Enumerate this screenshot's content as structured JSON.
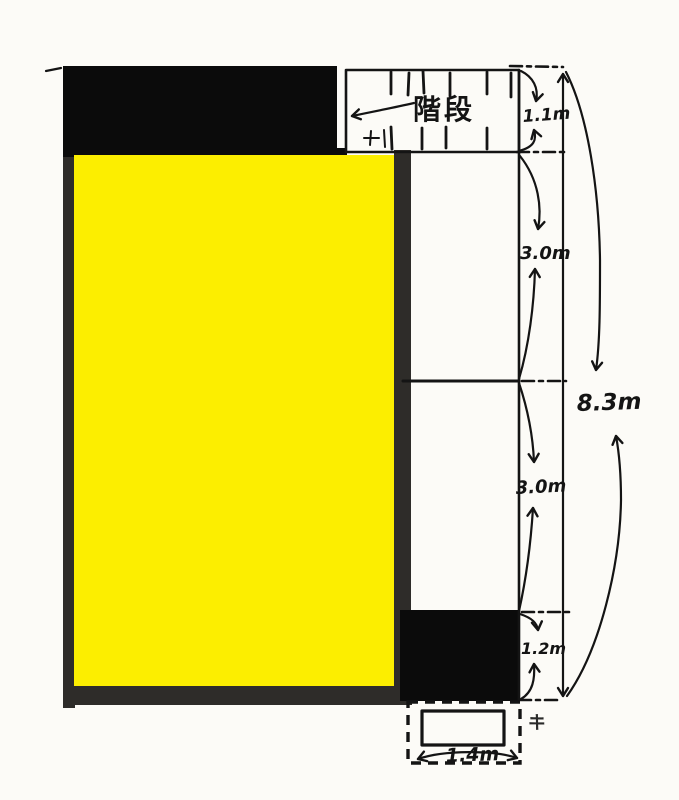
{
  "diagram": {
    "stairs_label": "階段",
    "right_dimensions": [
      {
        "value": "1.1m"
      },
      {
        "value": "3.0m"
      },
      {
        "value": "3.0m"
      },
      {
        "value": "1.2m"
      }
    ],
    "total_height": {
      "value": "8.3m"
    },
    "bottom_width": {
      "value": "1.4m"
    },
    "corner_mark": {
      "value": "キ"
    },
    "colors": {
      "highlight_yellow": "#fcee00",
      "solid_black": "#0b0b0b",
      "wall_gray": "#2e2c29",
      "ink": "#141414",
      "paper": "#fcfbf7"
    }
  }
}
